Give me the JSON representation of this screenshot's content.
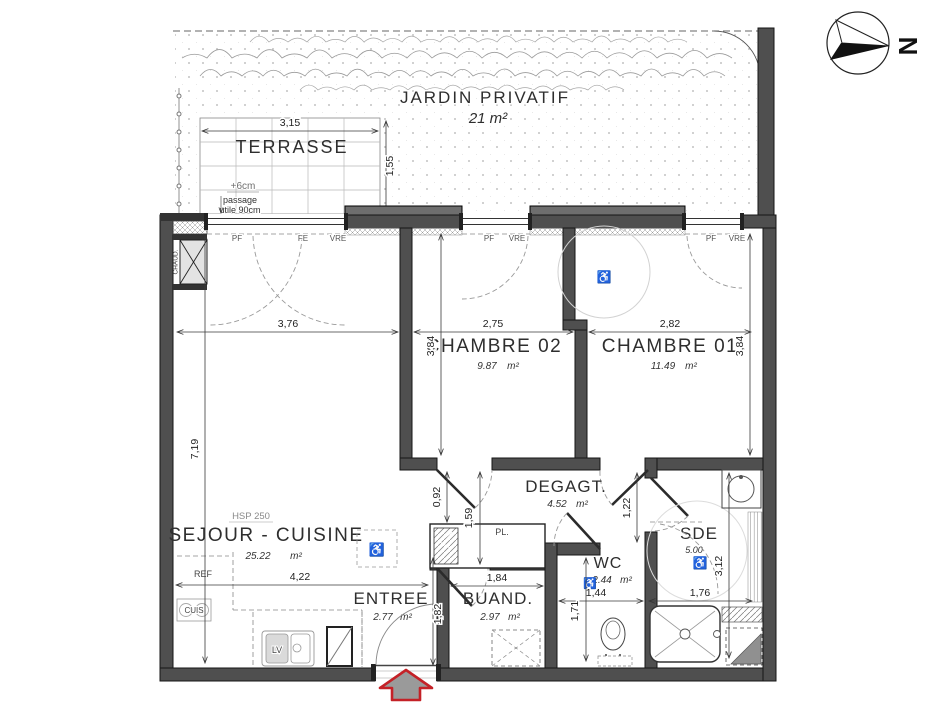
{
  "compass": {
    "north_label": "N"
  },
  "units": {
    "area": "m²"
  },
  "icons": {
    "wheelchair": "♿"
  },
  "garden": {
    "name": "JARDIN PRIVATIF",
    "area": "21 m²"
  },
  "terrace": {
    "name": "TERRASSE",
    "level_note": "+6cm",
    "passage_line1": "passage",
    "passage_line2": "utile 90cm",
    "width": "3,15",
    "depth": "1,55"
  },
  "openings": {
    "sejour": {
      "l1": "PF",
      "l2": "FE",
      "l3": "VRE"
    },
    "chambre02": {
      "l1": "PF",
      "l2": "VRE"
    },
    "chambre01": {
      "l1": "PF",
      "l2": "VRE"
    }
  },
  "rooms": {
    "sejour": {
      "name": "SEJOUR - CUISINE",
      "area": "25.22",
      "ceiling_note": "HSP 250",
      "dim_width": "3,76",
      "dim_height": "7,19",
      "dim_kitchen": "4,22"
    },
    "chambre02": {
      "name": "CHAMBRE 02",
      "area": "9.87",
      "dim_width": "2,75",
      "dim_height": "3,84"
    },
    "chambre01": {
      "name": "CHAMBRE 01",
      "area": "11.49",
      "dim_width": "2,82",
      "dim_height": "3,84"
    },
    "degagement": {
      "name": "DEGAGT.",
      "area": "4.52",
      "dim_west": "0,92",
      "dim_mid": "1,59",
      "dim_east": "1,22"
    },
    "entree": {
      "name": "ENTREE",
      "area": "2.77",
      "dim_height": "1,82"
    },
    "buanderie": {
      "name": "BUAND.",
      "area": "2.97",
      "dim_width": "1,84"
    },
    "wc": {
      "name": "WC",
      "area": "2.44",
      "dim_width": "1,44",
      "dim_height": "1,71"
    },
    "sde": {
      "name": "SDE",
      "area": "5.00",
      "dim_width": "1,76",
      "dim_height": "3,12"
    }
  },
  "fixtures": {
    "fridge": "REF",
    "cooktop": "CUIS",
    "sink_dishwasher": "LV",
    "boiler": "CHAUD.",
    "closet": "PL."
  },
  "colors": {
    "wall": "#4f4f4f",
    "accent_red": "#c42127",
    "accessibility_pink": "#c873be",
    "dim_line": "#3a3a3a",
    "terrace_grid": "#b8b8b8",
    "garden_dots": "#c2c2c2"
  }
}
